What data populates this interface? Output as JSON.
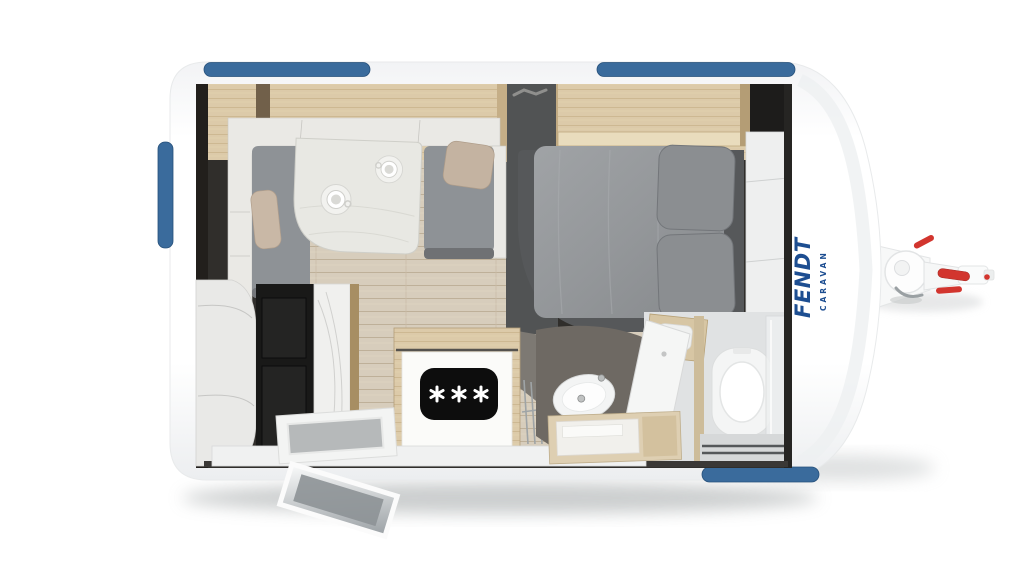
{
  "branding": {
    "logo_text": "FENDT",
    "logo_subtext": "CARAVAN",
    "logo_color": "#1d4e91"
  },
  "colors": {
    "background": "#ffffff",
    "body_white": "#fdfdfd",
    "accent_blue": "#3a6b9c",
    "accent_blue_edge": "#27517b",
    "logo_blue": "#1d4e91",
    "hitch_red": "#d2352e",
    "overhead_wood": "#dbc9a8",
    "floor_wood": "#d6ccba",
    "upholstery_gray": "#8e9296",
    "pillow_tan": "#c9b8a6",
    "bed_base_gray": "#56585a",
    "duvet_gray": "#94979a",
    "cooktop_black": "#0d0d0d",
    "interior_wall_dark": "#302e2b"
  },
  "icons": {
    "burner_icon_glyph": "✳",
    "burner_count": 3,
    "jockey_wheel_icon": "circle"
  }
}
